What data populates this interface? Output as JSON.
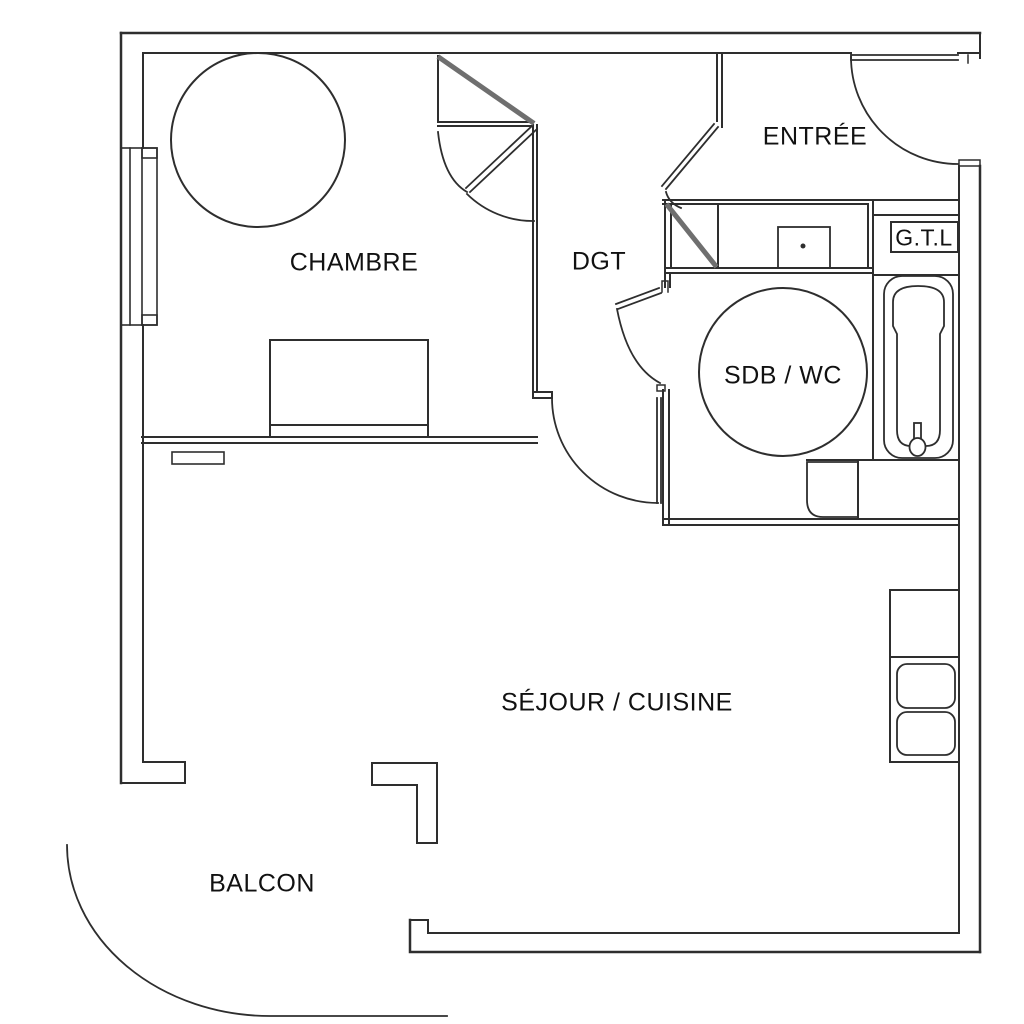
{
  "drawing": {
    "type": "architectural-floor-plan",
    "style": "black line drawing on white background"
  },
  "rooms": [
    {
      "id": "chambre",
      "label": "CHAMBRE"
    },
    {
      "id": "dgt",
      "label": "DGT"
    },
    {
      "id": "entree",
      "label": "ENTRÉE"
    },
    {
      "id": "sdb_wc",
      "label": "SDB / WC"
    },
    {
      "id": "gtl",
      "label": "G.T.L"
    },
    {
      "id": "sejour_cuisine",
      "label": "SÉJOUR / CUISINE"
    },
    {
      "id": "balcon",
      "label": "BALCON"
    }
  ],
  "fixtures": [
    "turning-circle-chambre",
    "bed",
    "radiator",
    "window",
    "closet-chambre",
    "closet-entree",
    "washbasin",
    "turning-circle-sdb",
    "bathtub",
    "toilet",
    "kitchen-counter",
    "kitchen-sink",
    "gtl-box",
    "entrance-door",
    "interior-doors",
    "balcony-edge"
  ],
  "colors": {
    "line": "#2e2e2e",
    "thick_diagonal": "#6f6f6f",
    "background": "#ffffff",
    "text": "#111111"
  }
}
